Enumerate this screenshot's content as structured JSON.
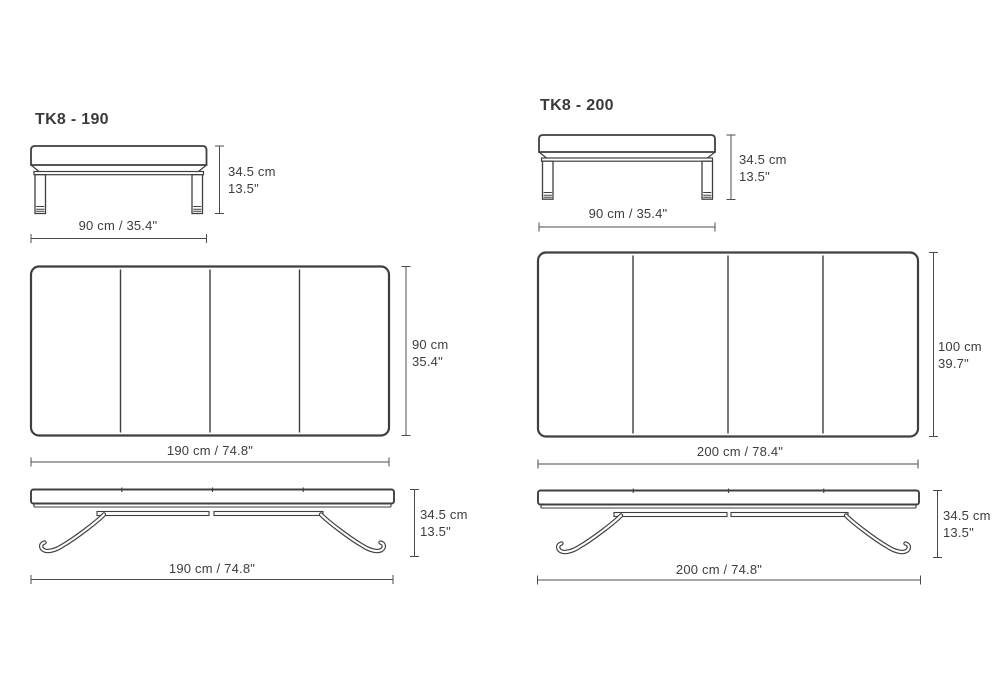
{
  "document": {
    "background_color": "#ffffff",
    "line_color": "#3f3f3f",
    "dimension_line_color": "#4c4c4c",
    "text_color": "#3d3d3d"
  },
  "products": [
    {
      "title": "TK8 - 190",
      "views": {
        "end": {
          "height_cm": "34.5 cm",
          "height_in": "13.5\"",
          "width_label": "90 cm / 35.4\""
        },
        "top": {
          "height_cm": "90 cm",
          "height_in": "35.4\"",
          "width_label": "190 cm / 74.8\""
        },
        "side": {
          "height_cm": "34.5 cm",
          "height_in": "13.5\"",
          "width_label": "190 cm / 74.8\""
        }
      }
    },
    {
      "title": "TK8 - 200",
      "views": {
        "end": {
          "height_cm": "34.5 cm",
          "height_in": "13.5\"",
          "width_label": "90 cm / 35.4\""
        },
        "top": {
          "height_cm": "100 cm",
          "height_in": "39.7\"",
          "width_label": "200 cm / 78.4\""
        },
        "side": {
          "height_cm": "34.5 cm",
          "height_in": "13.5\"",
          "width_label": "200 cm / 74.8\""
        }
      }
    }
  ]
}
